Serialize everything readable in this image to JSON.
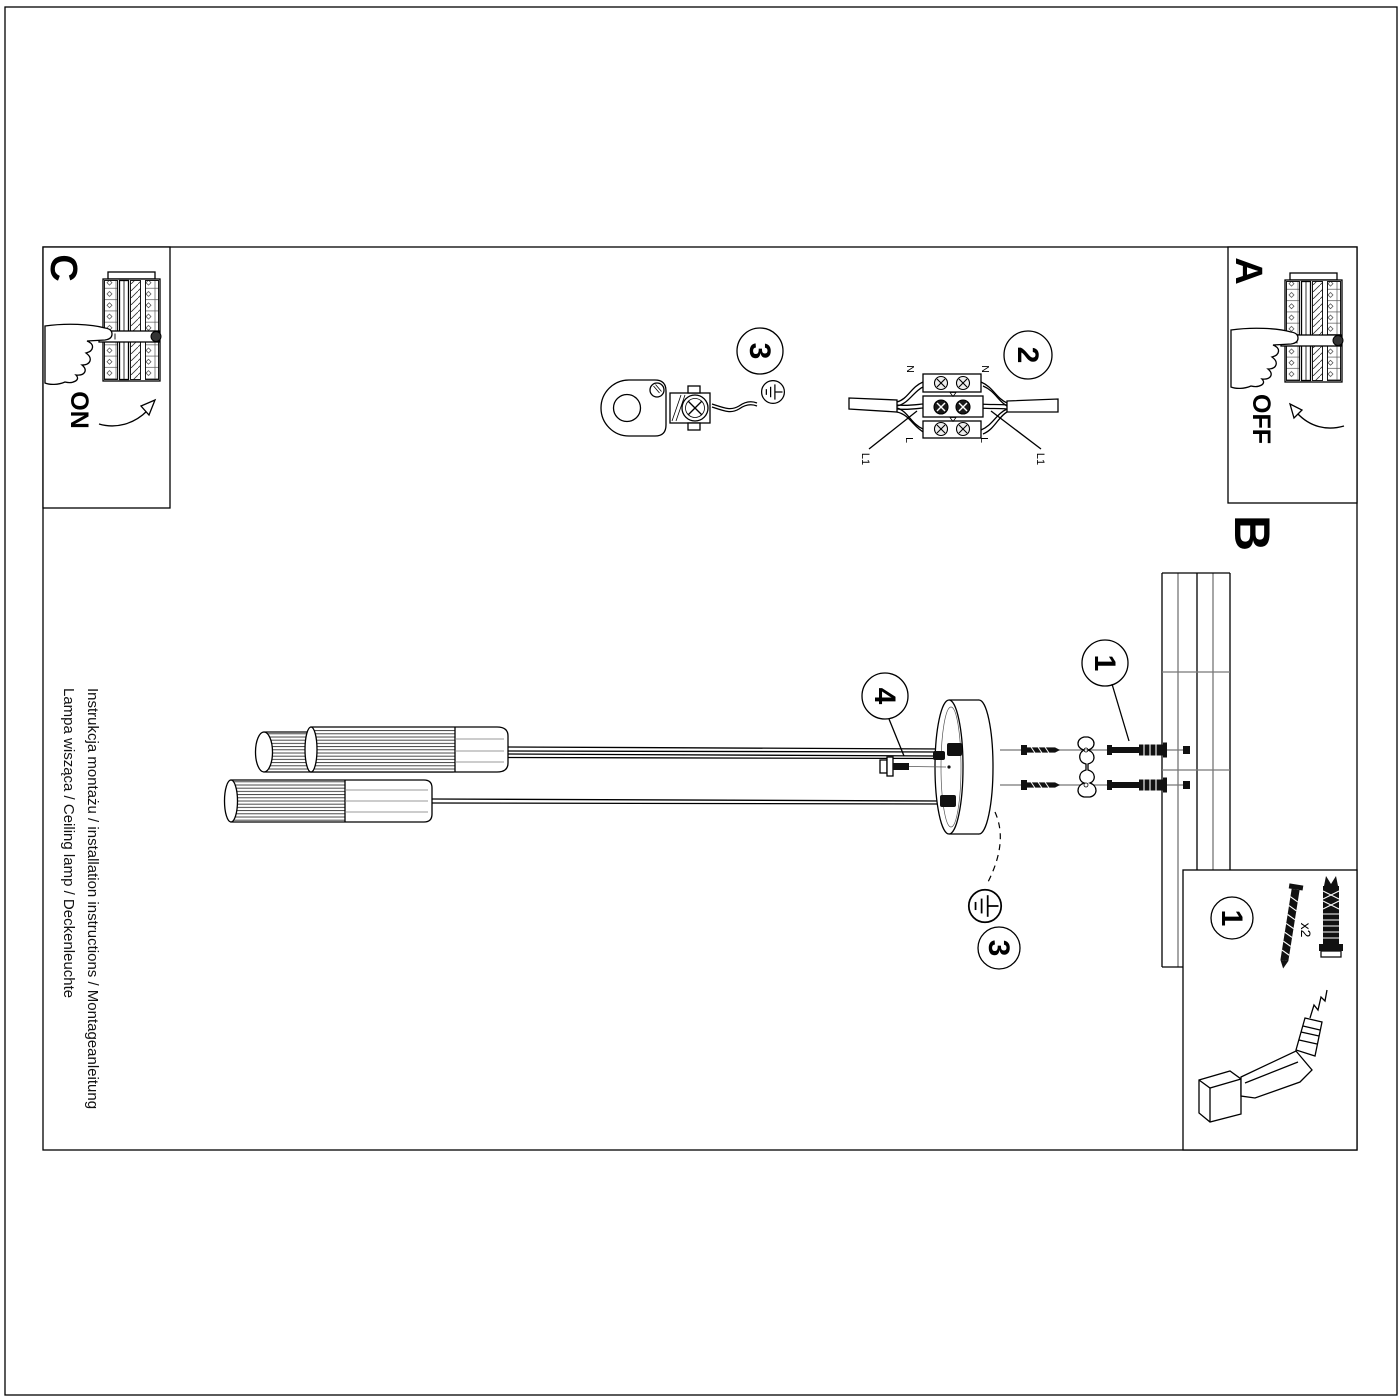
{
  "page": {
    "steps": {
      "a_label": "A",
      "b_label": "B",
      "c_label": "C",
      "power_off": "OFF",
      "power_on": "ON"
    },
    "callouts": {
      "n1": "1",
      "n2": "2",
      "n3": "3",
      "n4": "4"
    },
    "wiring_labels": {
      "neutral": "N",
      "live": "L",
      "switched_live": "L1"
    },
    "hardware": {
      "anchor_quantity": "x2"
    },
    "footer": {
      "line1": "Instrukcja montażu / installation instructions / Montageanleitung",
      "line2": "Lampa wisząca / Ceiling lamp / Deckenleuchte"
    }
  }
}
